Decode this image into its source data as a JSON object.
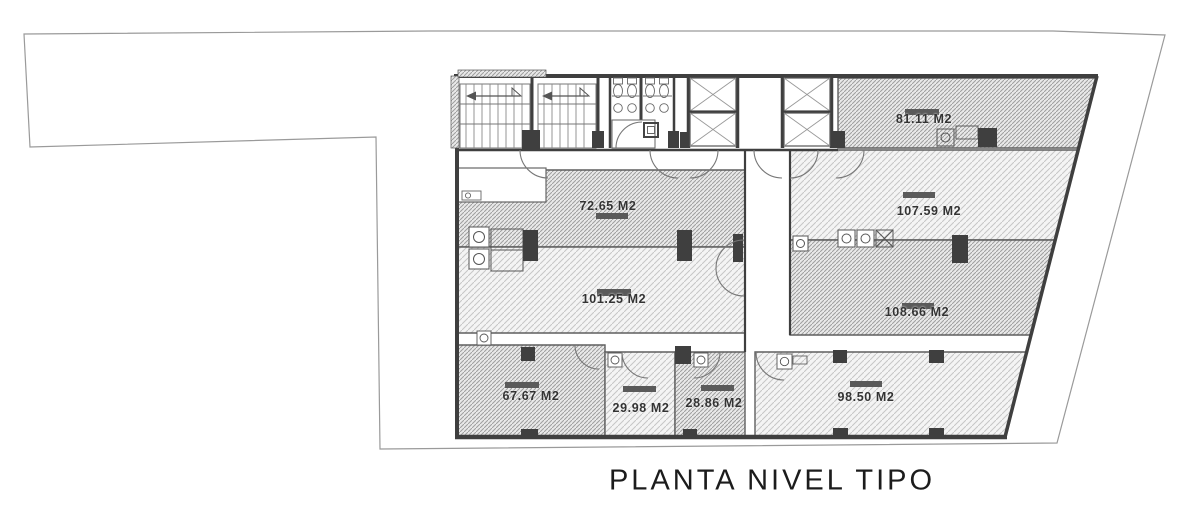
{
  "title": "PLANTA NIVEL TIPO",
  "rooms": [
    {
      "name": "top-right-office",
      "area_label": "81.11 M2"
    },
    {
      "name": "upper-left-office",
      "area_label": "72.65 M2"
    },
    {
      "name": "upper-right-office",
      "area_label": "107.59 M2"
    },
    {
      "name": "mid-left-office",
      "area_label": "101.25 M2"
    },
    {
      "name": "mid-right-office",
      "area_label": "108.66 M2"
    },
    {
      "name": "bottom-left-office",
      "area_label": "67.67 M2"
    },
    {
      "name": "bottom-small-office-1",
      "area_label": "29.98 M2"
    },
    {
      "name": "bottom-small-office-2",
      "area_label": "28.86 M2"
    },
    {
      "name": "bottom-right-office",
      "area_label": "98.50 M2"
    }
  ],
  "colors": {
    "wall": "#3f3f3f",
    "hatch_dark": "#9e9e9e",
    "hatch_light": "#c6c6c6",
    "boundary": "#9a9a9a",
    "bar": "#5a5a5a",
    "label": "#333333",
    "title": "#1c1c1c"
  }
}
